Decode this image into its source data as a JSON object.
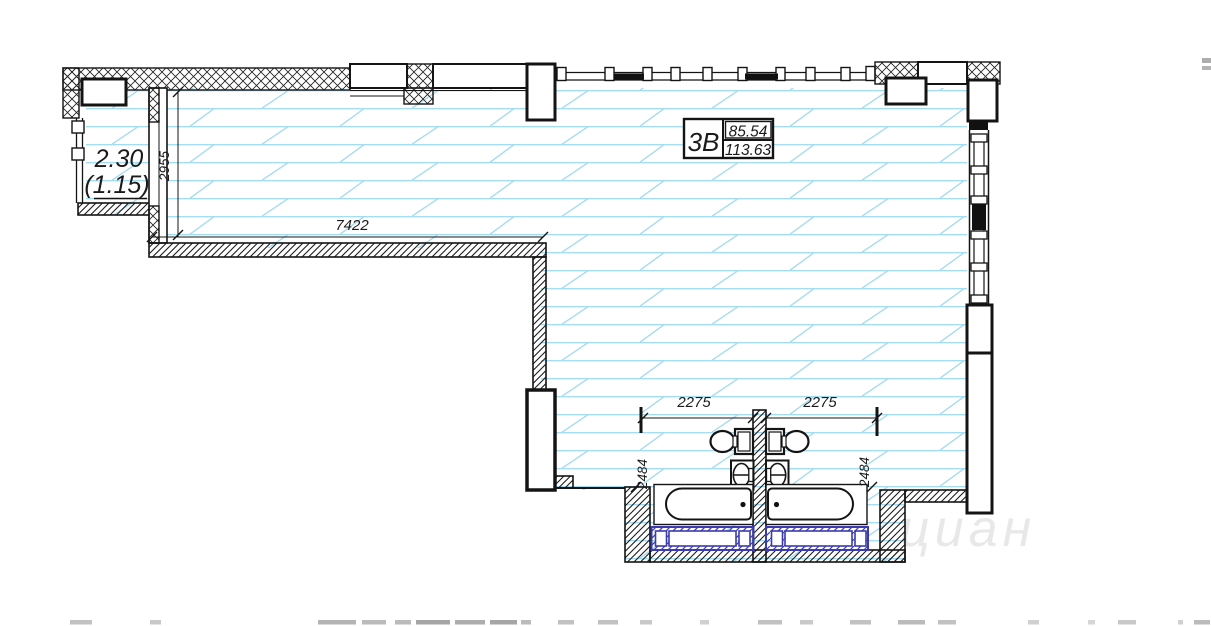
{
  "floor_plan": {
    "unit_info_box": {
      "unit_type": "3В",
      "area_top": "85.54",
      "area_bottom": "113.63"
    },
    "balcony_label": {
      "area_full": "2.30",
      "area_reduced": "(1.15)"
    },
    "dimensions": {
      "room_width": "7422",
      "balcony_room_depth": "2955",
      "bathroom_left_width": "2275",
      "bathroom_right_width": "2275",
      "bathroom_left_depth": "2484",
      "bathroom_right_depth": "2484"
    },
    "watermark": "циан",
    "fixtures": [
      "toilet-left",
      "toilet-right",
      "washbasin-left",
      "washbasin-right",
      "bathtub-left",
      "bathtub-right",
      "duct-box-left",
      "duct-box-right"
    ],
    "colors": {
      "floor_hatch_blue": "#a5dcf2",
      "line_black": "#141414",
      "duct_blue": "#3b3bae",
      "watermark_gray": "rgba(58,58,58,0.10)"
    }
  }
}
